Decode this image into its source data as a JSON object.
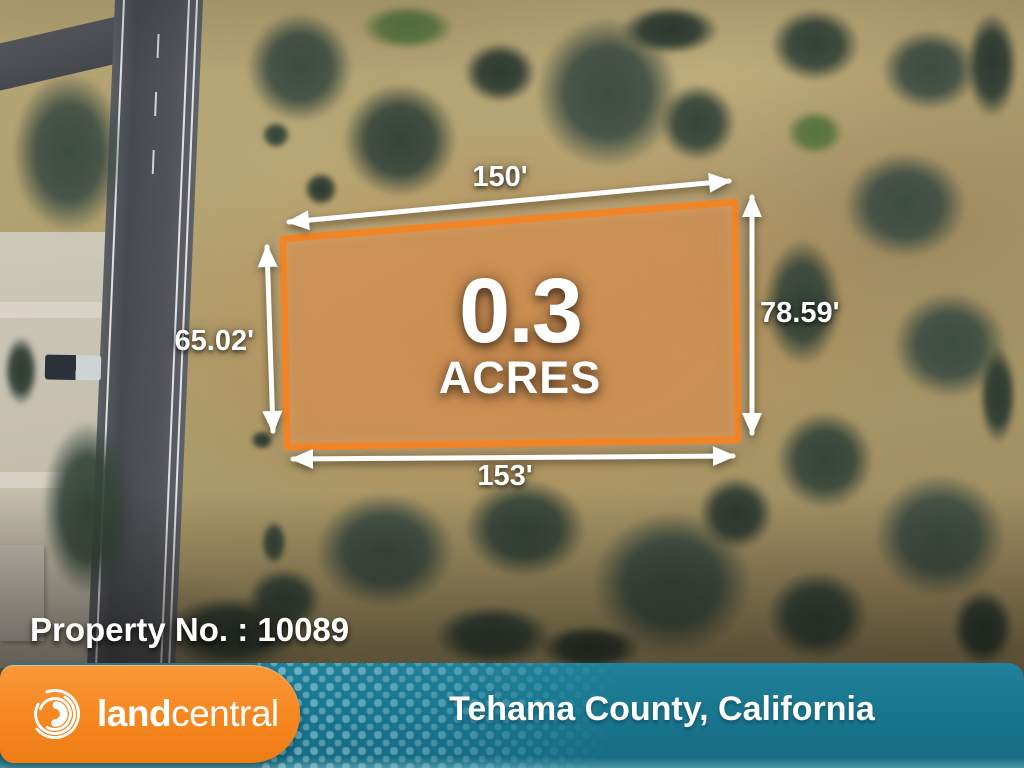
{
  "map": {
    "dimensions": {
      "top": "150'",
      "right": "78.59'",
      "bottom": "153'",
      "left": "65.02'"
    },
    "acreage": {
      "value": "0.3",
      "unit": "ACRES"
    },
    "property_label": "Property No. : 10089"
  },
  "footer": {
    "brand_bold": "land",
    "brand_regular": "central",
    "location": "Tehama County, California",
    "logo_icon": "swirl-logo-icon"
  },
  "colors": {
    "brand_orange": "#f6861f",
    "brand_teal": "#19768f",
    "parcel_outline": "#f08426",
    "parcel_fill": "rgba(243,138,52,0.42)",
    "dimension_arrow": "#ffffff",
    "overlay_text": "#ffffff"
  }
}
